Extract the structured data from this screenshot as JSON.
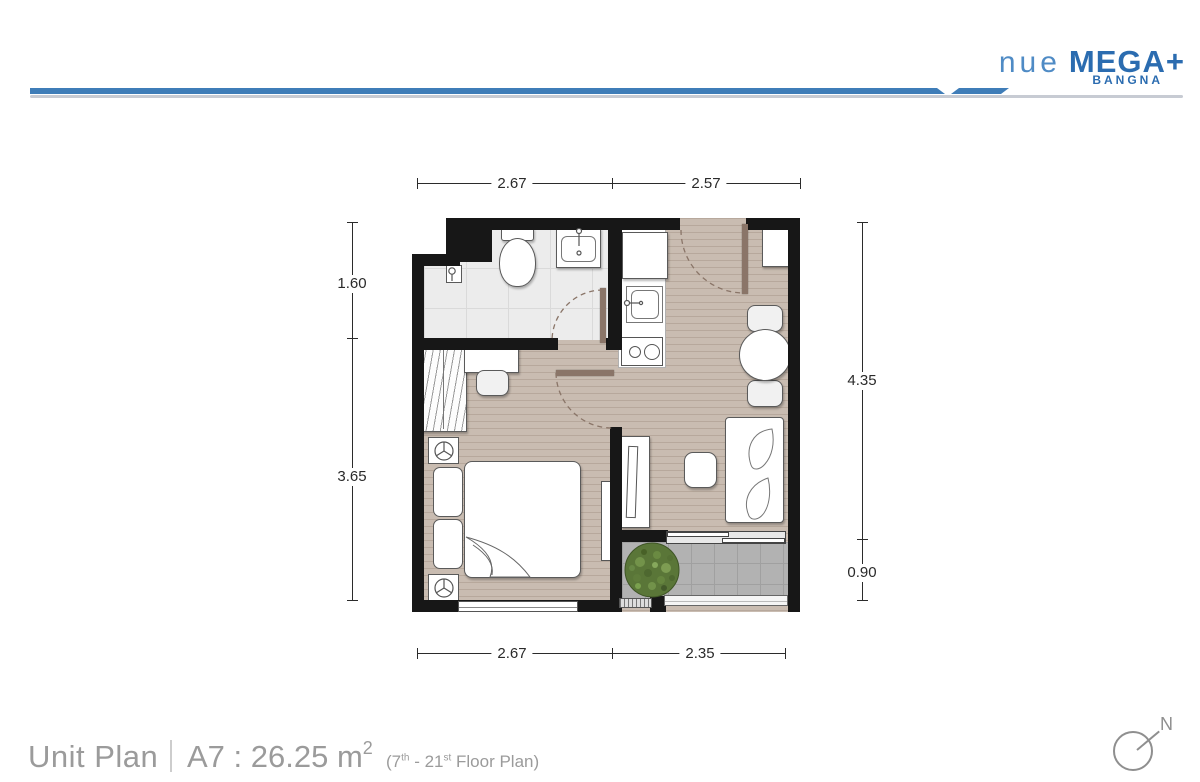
{
  "header": {
    "logo": {
      "brand_light": "nue",
      "brand_bold": "MEGA+",
      "location": "BANGNA"
    },
    "colors": {
      "logo_light_blue": "#4f8bc5",
      "logo_dark_blue": "#2b6cb0",
      "bar_blue": "#3f7db8",
      "rule_gray": "#c7cbd3"
    }
  },
  "plan": {
    "dimensions": {
      "top": [
        "2.67",
        "2.57"
      ],
      "bottom": [
        "2.67",
        "2.35"
      ],
      "left": [
        "1.60",
        "3.65"
      ],
      "right": [
        "4.35",
        "0.90"
      ]
    },
    "colors": {
      "wall": "#171717",
      "floor_wood": "#c9bcb1",
      "floor_bath": "#ececec",
      "floor_balcony": "#b2b2b2",
      "door_leaf": "#8a7568",
      "plant_green": "#5a7638"
    }
  },
  "footer": {
    "title": "Unit Plan",
    "unit_label": "A7 : 26.25 m",
    "unit_sup": "2",
    "note": {
      "p1": "(7",
      "s1": "th",
      "p2": " - 21",
      "s2": "st",
      "p3": " Floor Plan)"
    },
    "compass_label": "N"
  }
}
